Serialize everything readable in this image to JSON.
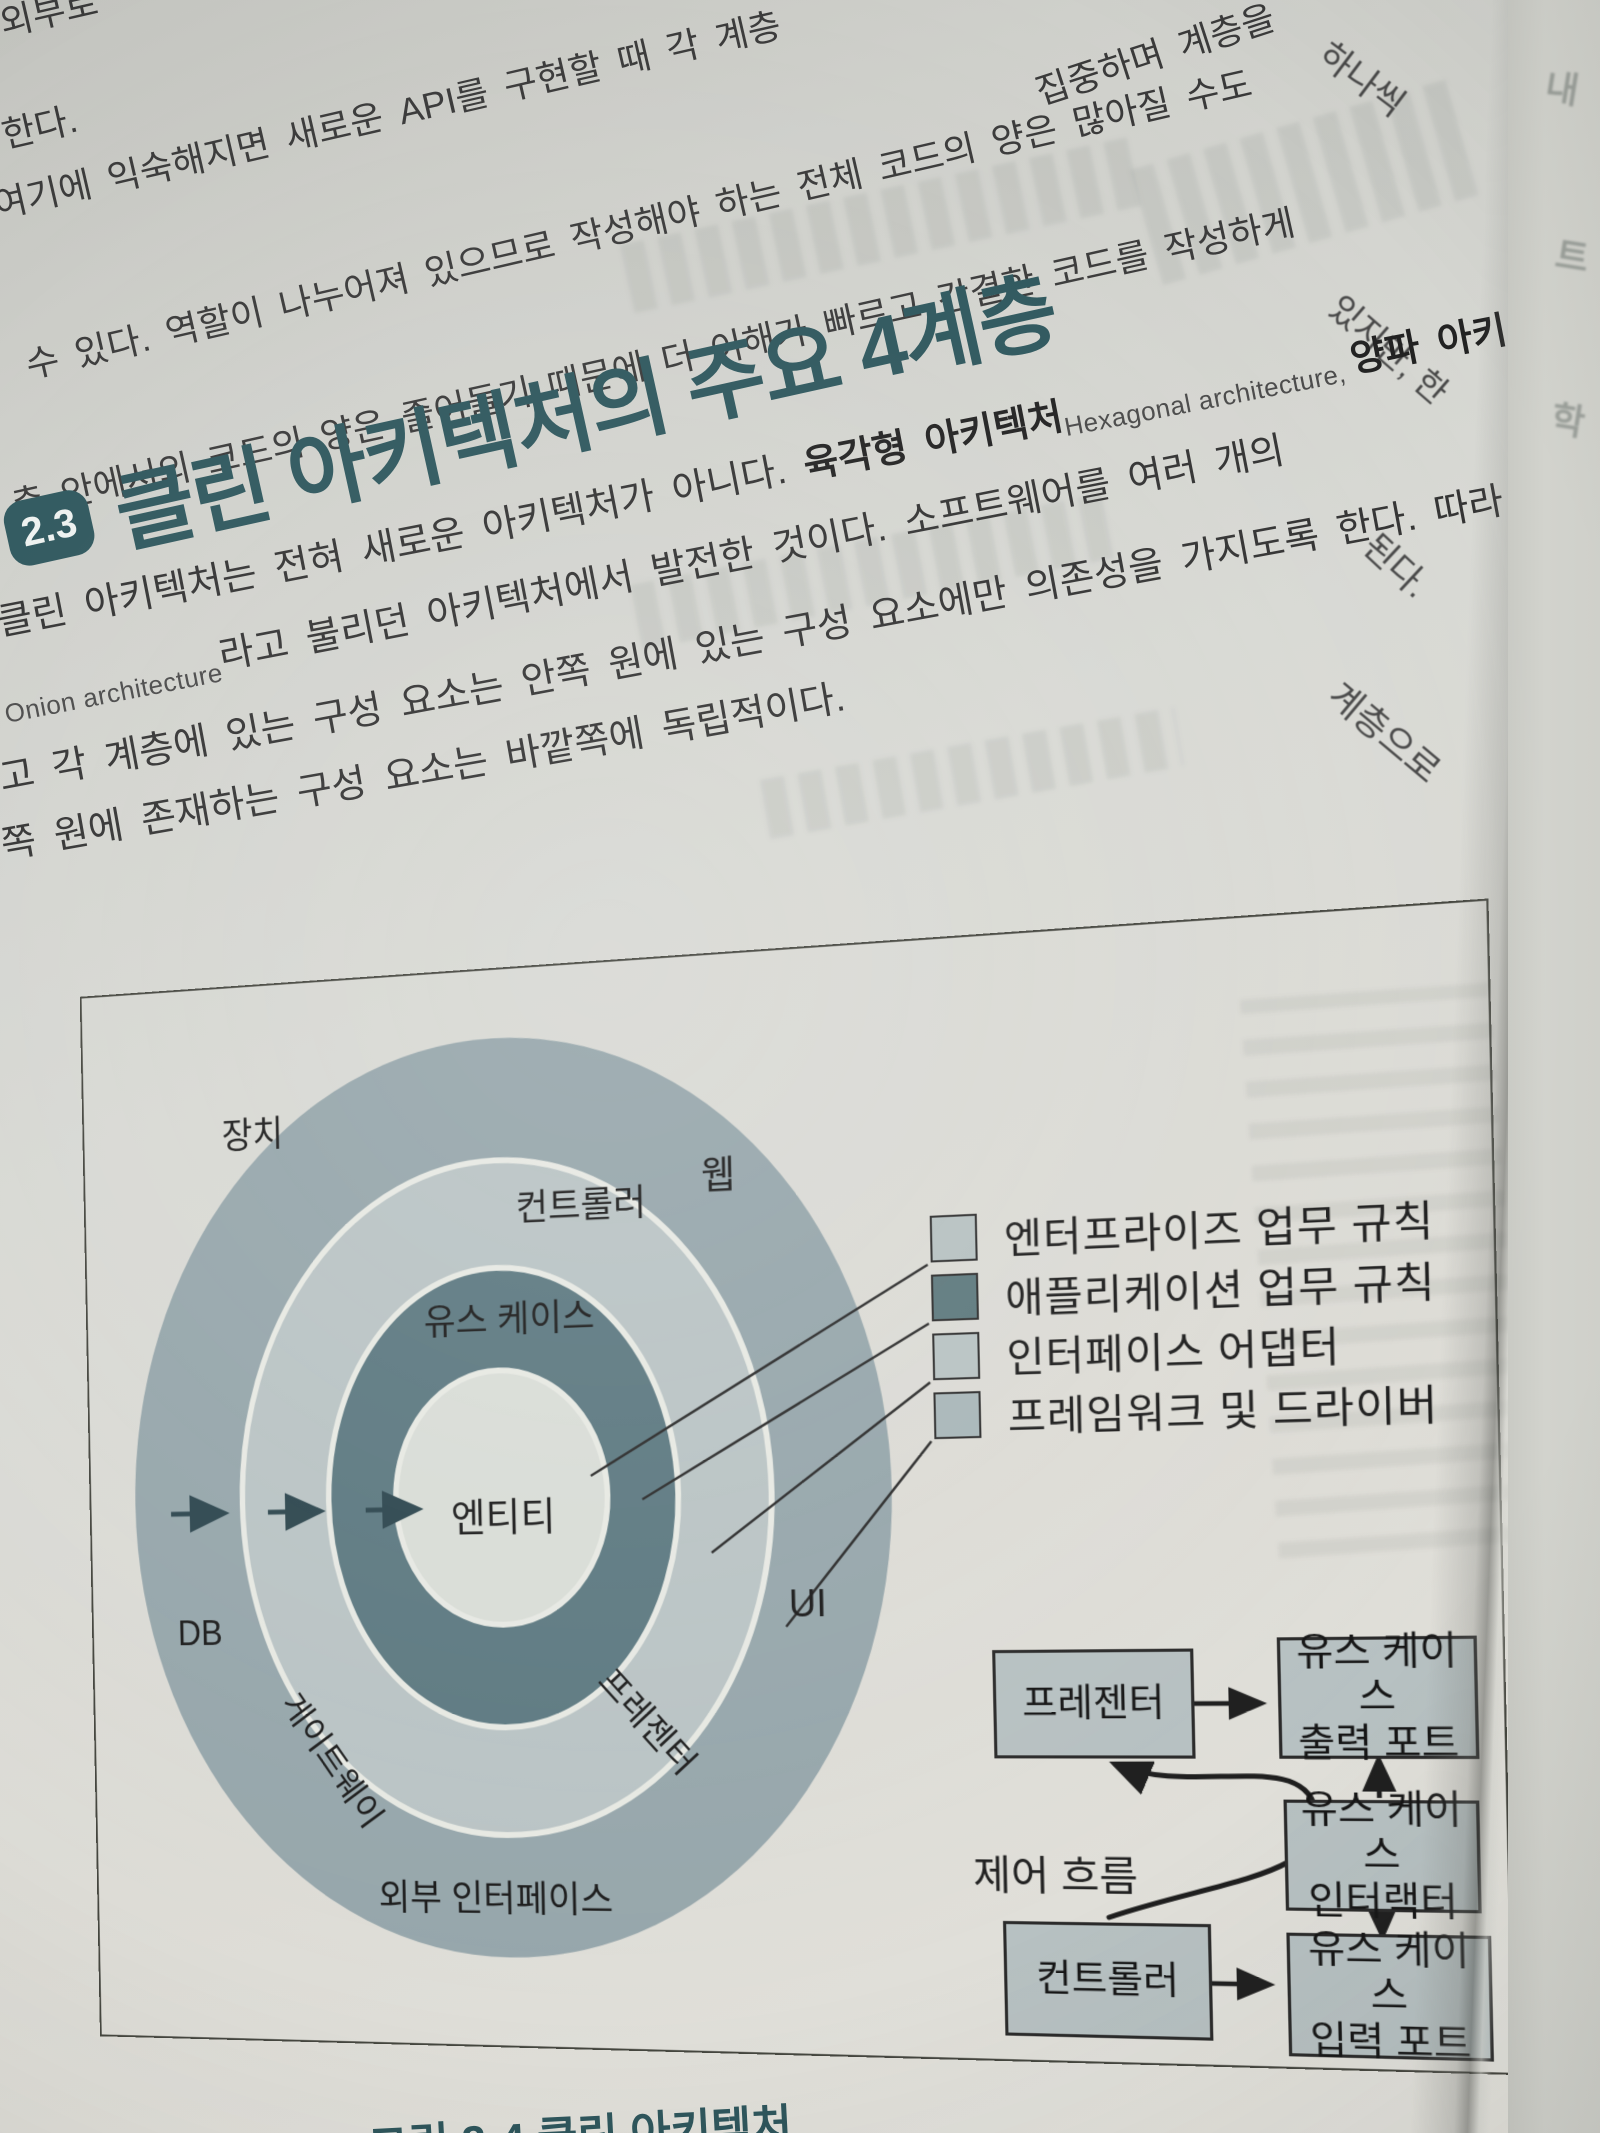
{
  "top_text": {
    "fragment1": "외부로",
    "fragment2": "한다.",
    "line1": "여기에 익숙해지면 새로운 API를 구현할 때 각 계층",
    "line1_tail": "집중하며 계층을",
    "line1_tail2": "하나씩",
    "line2": "수 있다. 역할이 나누어져 있으므로 작성해야 하는 전체 코드의 양은 많아질 수도",
    "line2_tail": "있지만, 한",
    "line3": "층 안에서의 코드의 양은 줄어들기 때문에 더 이해가 빠르고 간결한 코드를 작성하게",
    "line3_tail": "된다."
  },
  "section": {
    "number": "2.3",
    "title": "클린 아키텍처의 주요 4계층"
  },
  "paragraph": {
    "p1_normal": "클린 아키텍처는 전혀 새로운 아키텍처가 아니다. ",
    "p1_bold": "육각형 아키텍처",
    "p1_en": "Hexagonal architecture, ",
    "p1_bold2": "양파 아키",
    "p2_en": "Onion architecture",
    "p2_rest": "라고 불리던 아키텍처에서 발전한 것이다. 소프트웨어를 여러 개의",
    "p2_tail": "계층으로",
    "p3": "고 각 계층에 있는 구성 요소는 안쪽 원에 있는 구성 요소에만 의존성을 가지도록 한다. 따라",
    "p4": "쪽 원에 존재하는 구성 요소는 바깥쪽에 독립적이다."
  },
  "figure": {
    "rings": {
      "labels": {
        "device": "장치",
        "controller": "컨트롤러",
        "web": "웹",
        "usecase": "유스 케이스",
        "entity": "엔티티",
        "db": "DB",
        "gateway": "게이트웨이",
        "presenter": "프레젠터",
        "ui": "UI",
        "external": "외부 인터페이스"
      },
      "colors": {
        "outer": "#97a7ac",
        "adapters": "#bac4c5",
        "usecase": "#5e7a82",
        "entity": "#d9ddd7",
        "gap": "#e7e9e3"
      }
    },
    "legend": {
      "items": [
        {
          "label": "엔터프라이즈 업무 규칙",
          "color": "#b7c2c2"
        },
        {
          "label": "애플리케이션 업무 규칙",
          "color": "#5f7a7e"
        },
        {
          "label": "인터페이스 어댑터",
          "color": "#b9c3c3"
        },
        {
          "label": "프레임워크 및 드라이버",
          "color": "#a9b7b9"
        }
      ]
    },
    "flow": {
      "presenter": "프레젠터",
      "controller": "컨트롤러",
      "output_port_line1": "유스 케이스",
      "output_port_line2": "출력 포트",
      "interactor_line1": "유스 케이스",
      "interactor_line2": "인터랙터",
      "input_port_line1": "유스 케이스",
      "input_port_line2": "입력 포트",
      "control_flow": "제어 흐름"
    }
  },
  "caption": "그림 2-4 클린 아키텍처",
  "side_page_chars": {
    "c1": "내",
    "c2": "트",
    "c3": "학"
  },
  "colors": {
    "heading": "#2e575d",
    "body_text": "#3a3a3a",
    "figure_border": "#45463f",
    "flow_box_fill": "#b7c1c2"
  }
}
